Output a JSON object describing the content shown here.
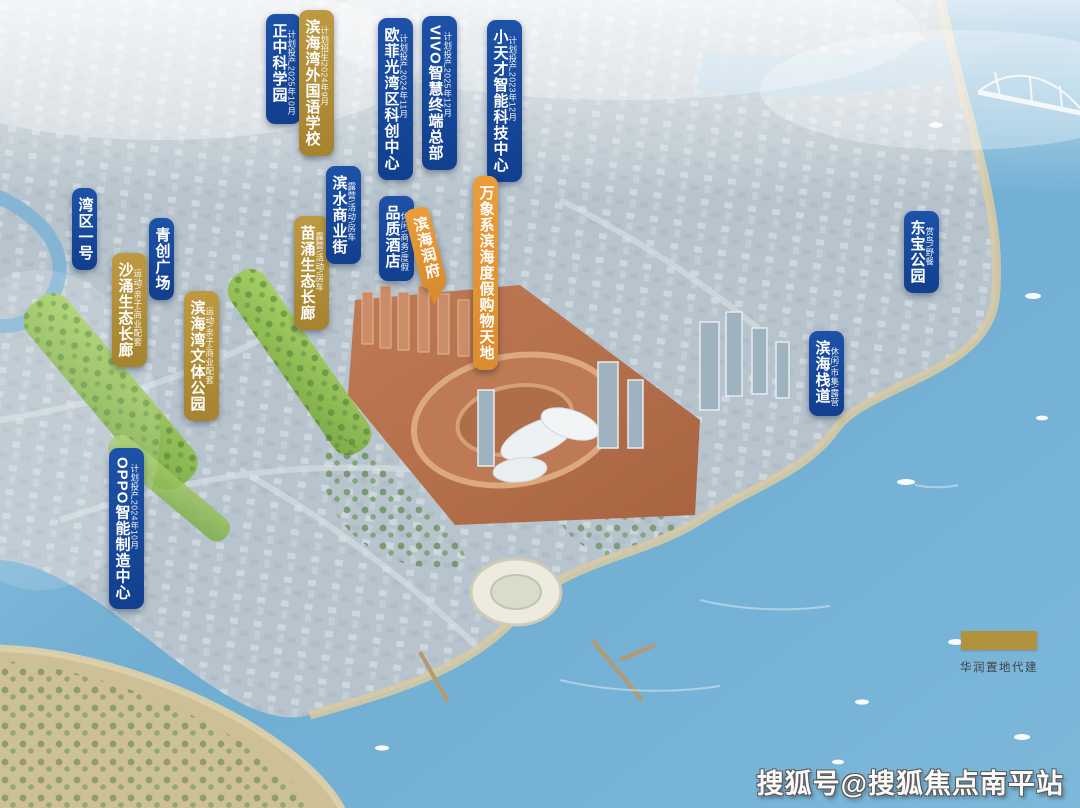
{
  "palette": {
    "label_blue": "#17499d",
    "label_gold": "#b3903c",
    "label_orange": "#e6973a",
    "sea": "#6aa8cd"
  },
  "labels": [
    {
      "id": "zhengzhong",
      "text": "正中科学园",
      "note": "计划投产2025年10月",
      "style": "blue"
    },
    {
      "id": "school",
      "text": "滨海湾外国语学校",
      "note": "计划招生2024年9月",
      "style": "gold"
    },
    {
      "id": "ofilm",
      "text": "欧菲光湾区科创中心",
      "note": "计划投产2024年11月",
      "style": "blue"
    },
    {
      "id": "vivo",
      "text": "VIVO智慧终端总部",
      "note": "计划投产2025年12月",
      "style": "blue"
    },
    {
      "id": "xtc",
      "text": "小天才智能科技中心",
      "note": "计划投产2023年12月",
      "style": "blue"
    },
    {
      "id": "bayone",
      "text": "湾区一号",
      "note": "",
      "style": "blue"
    },
    {
      "id": "qingchuang",
      "text": "青创广场",
      "note": "",
      "style": "blue"
    },
    {
      "id": "shachong",
      "text": "沙涌生态长廊",
      "note": "运动\\亲子\\商业配套",
      "style": "gold"
    },
    {
      "id": "wenti",
      "text": "滨海湾文体公园",
      "note": "运动\\亲子\\商业配套",
      "style": "gold"
    },
    {
      "id": "miaochong",
      "text": "苗涌生态长廊",
      "note": "露营\\活动\\房车",
      "style": "gold"
    },
    {
      "id": "binshui",
      "text": "滨水商业街",
      "note": "露营\\活动\\房车",
      "style": "blue"
    },
    {
      "id": "hotel",
      "text": "品质酒店",
      "note": "休闲\\商务\\度假",
      "style": "blue"
    },
    {
      "id": "runfu",
      "text": "滨海润府",
      "note": "",
      "style": "orange"
    },
    {
      "id": "wanxiang",
      "text": "万象系滨海度假购物天地",
      "note": "",
      "style": "orange"
    },
    {
      "id": "dongbao",
      "text": "东宝公园",
      "note": "赏鸟\\野餐",
      "style": "blue"
    },
    {
      "id": "zhandao",
      "text": "滨海栈道",
      "note": "休闲\\市集\\露营",
      "style": "blue"
    },
    {
      "id": "oppo",
      "text": "OPPO智能制造中心",
      "note": "计划投产2024年10月",
      "style": "blue"
    }
  ],
  "legend": {
    "label": "华润置地代建",
    "color": "#b2923f"
  },
  "watermark": "搜狐号@搜狐焦点南平站"
}
